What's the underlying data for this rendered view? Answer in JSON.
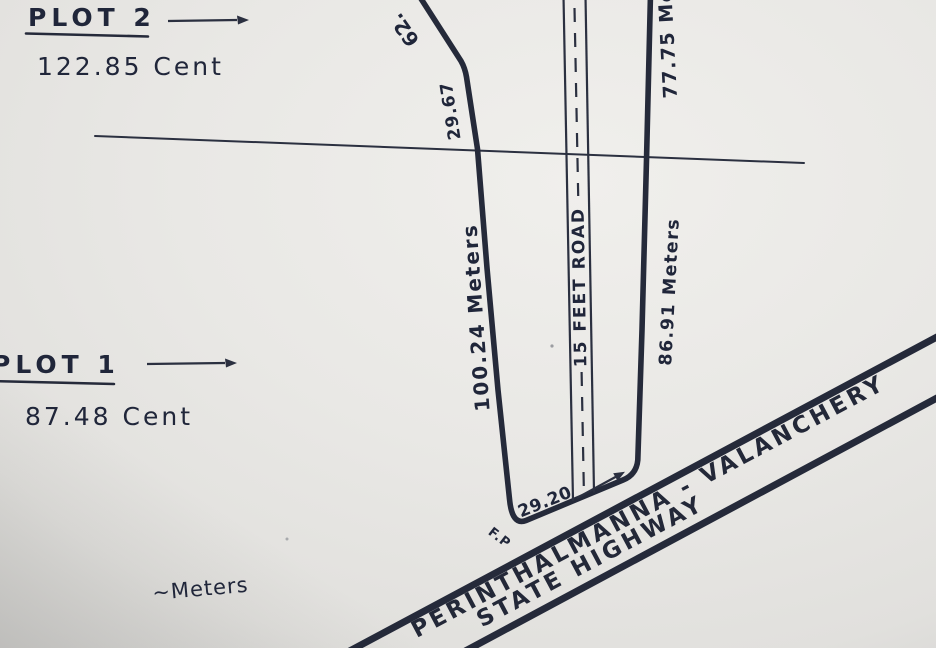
{
  "colors": {
    "ink": "#252a3a",
    "thin_ink": "#2b3040",
    "paper": "#e9e8e5"
  },
  "plots": {
    "plot2": {
      "title": "PLOT 2",
      "area": "122.85 Cent"
    },
    "plot1": {
      "title": "PLOT 1",
      "area": "87.48 Cent"
    }
  },
  "dimensions": {
    "top_cut": "62.",
    "upper_left_segment": "29.67",
    "left_boundary": "100.24 Meters",
    "right_boundary_upper": "77.75 Meters",
    "right_boundary_lower": "86.91 Meters",
    "highway_frontage": "29.20"
  },
  "road": {
    "label": "15 FEET ROAD"
  },
  "highway": {
    "name_line1": "PERINTHALMANNA - VALANCHERY",
    "name_line2": "STATE  HIGHWAY"
  },
  "annotations": {
    "units_note": "~Meters",
    "corner_marker": "F.P"
  }
}
